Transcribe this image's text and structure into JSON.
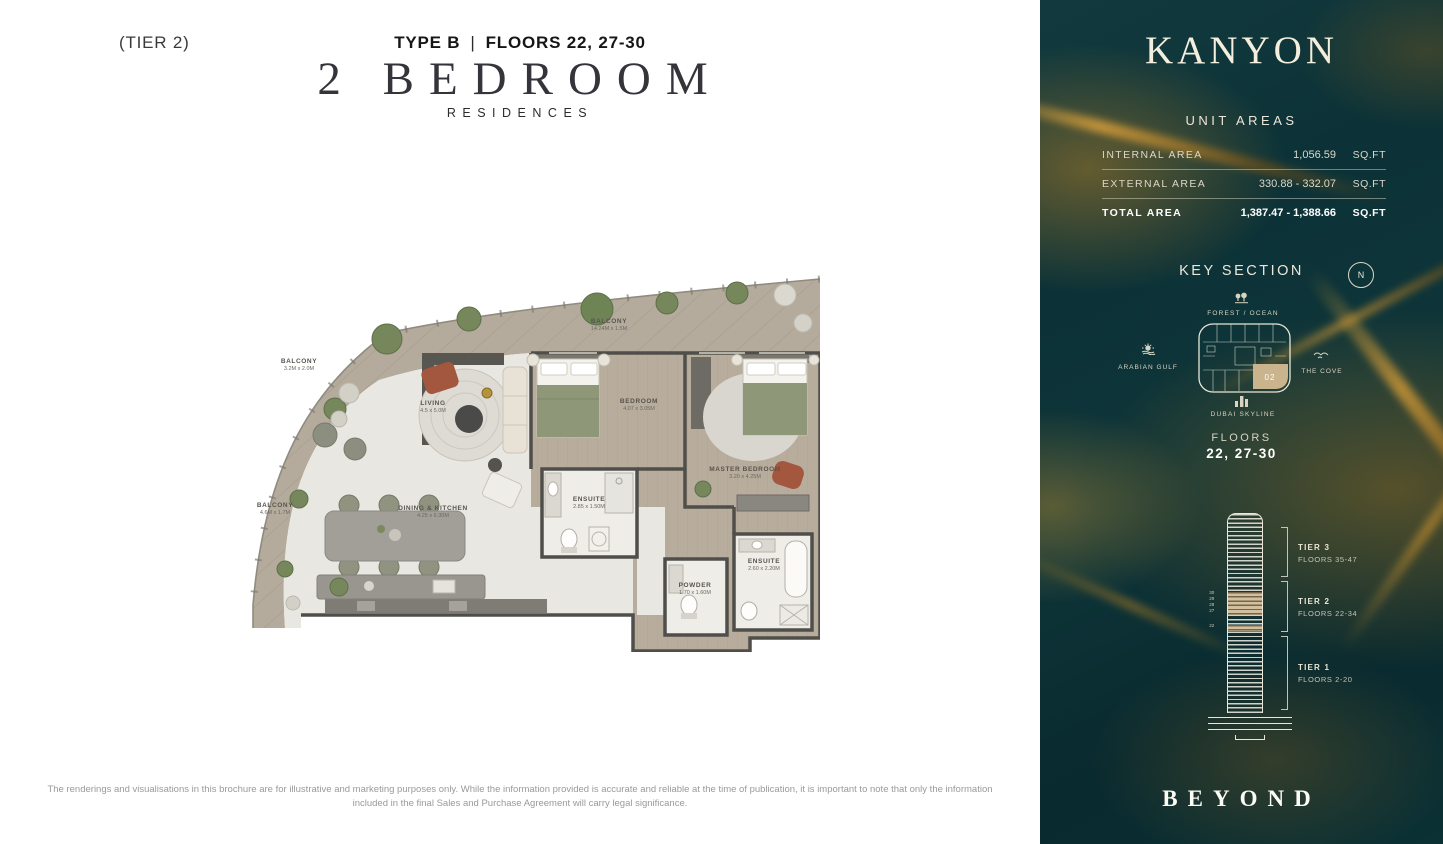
{
  "page": {
    "header": {
      "type_label": "TYPE B",
      "separator": "|",
      "floors_label": "FLOORS 22, 27-30",
      "tier_label": "(TIER 2)",
      "title": "2 BEDROOM",
      "subtitle": "RESIDENCES"
    },
    "disclaimer": "The renderings and visualisations in this brochure are for illustrative and marketing purposes only. While the information provided is accurate and reliable at the time of publication, it is important to note that only the information included in the final Sales and Purchase Agreement will carry legal significance."
  },
  "floorplan": {
    "rooms": {
      "balcony_top": {
        "label": "BALCONY",
        "dims": "14.24M x 1.5M"
      },
      "balcony_upper_left": {
        "label": "BALCONY",
        "dims": "3.2M x 2.0M"
      },
      "balcony_left": {
        "label": "BALCONY",
        "dims": "4.6M x 1.7M"
      },
      "living": {
        "label": "LIVING",
        "dims": "4.5 x 5.0M"
      },
      "dining_kitchen": {
        "label": "DINING & KITCHEN",
        "dims": "4.25 x 6.30M"
      },
      "bedroom": {
        "label": "BEDROOM",
        "dims": "4.07 x 3.05M"
      },
      "master_bedroom": {
        "label": "MASTER BEDROOM",
        "dims": "3.20 x 4.25M"
      },
      "ensuite": {
        "label": "ENSUITE",
        "dims": "2.85 x 1.50M"
      },
      "master_ensuite": {
        "label": "ENSUITE",
        "dims": "2.60 x 2.20M"
      },
      "powder": {
        "label": "POWDER",
        "dims": "1.70 x 1.60M"
      }
    }
  },
  "sidebar": {
    "brand": "KANYON",
    "unit_areas": {
      "heading": "UNIT AREAS",
      "rows": [
        {
          "label": "INTERNAL AREA",
          "value": "1,056.59",
          "unit": "SQ.FT"
        },
        {
          "label": "EXTERNAL AREA",
          "value": "330.88 - 332.07",
          "unit": "SQ.FT"
        },
        {
          "label": "TOTAL AREA",
          "value": "1,387.47 - 1,388.66",
          "unit": "SQ.FT"
        }
      ]
    },
    "key_section": {
      "heading": "KEY SECTION",
      "compass": "N",
      "labels": {
        "top": "FOREST / OCEAN",
        "left": "ARABIAN GULF",
        "right": "THE COVE",
        "bottom": "DUBAI SKYLINE"
      },
      "unit_number": "02"
    },
    "floors": {
      "label": "FLOORS",
      "value": "22, 27-30"
    },
    "tower": {
      "tiers": [
        {
          "name": "TIER 3",
          "floors": "FLOORS 35-47"
        },
        {
          "name": "TIER 2",
          "floors": "FLOORS 22-34"
        },
        {
          "name": "TIER 1",
          "floors": "FLOORS 2-20"
        }
      ],
      "highlighted_floors": [
        "30",
        "29",
        "28",
        "27",
        "22"
      ]
    },
    "footer_brand": "BEYOND"
  },
  "colors": {
    "panel_teal": "#0b3034",
    "vein_gold": "#b98a2e",
    "highlight_tan": "#d2bf9e",
    "cream": "#efe9d8"
  }
}
